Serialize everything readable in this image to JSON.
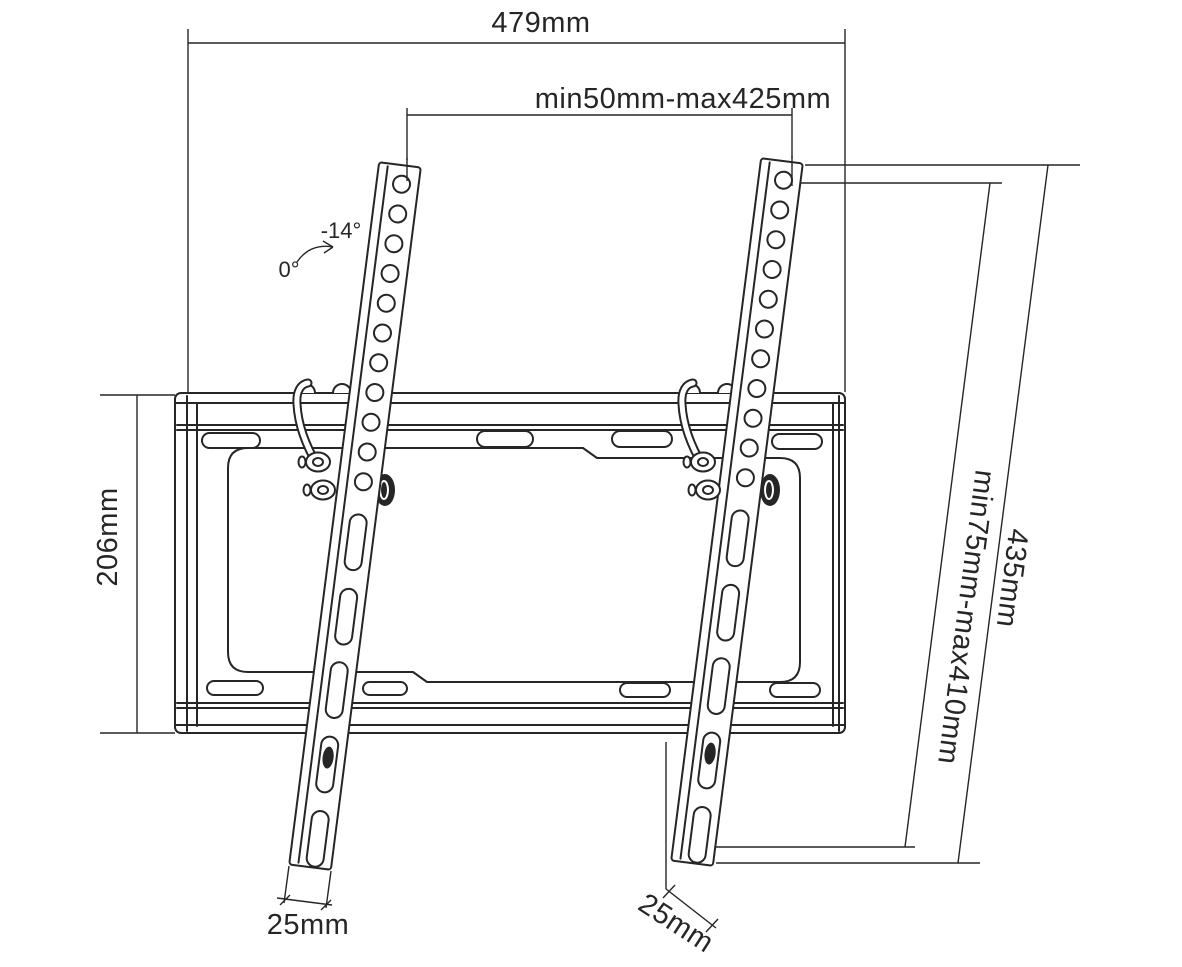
{
  "diagram": {
    "dimensions": {
      "overall_width": "479mm",
      "horizontal_pattern": "min50mm-max425mm",
      "plate_height": "206mm",
      "vertical_pattern": "min75mm-max410mm",
      "rail_length": "435mm",
      "rail_width_left": "25mm",
      "rail_width_right": "25mm"
    },
    "tilt": {
      "max_label": "-14°",
      "min_label": "0°"
    },
    "colors": {
      "ink": "#262626",
      "background": "#ffffff"
    }
  }
}
